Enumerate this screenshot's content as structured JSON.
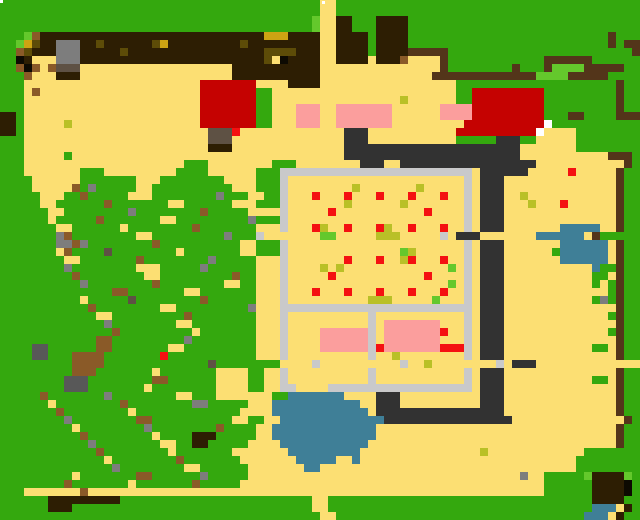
{
  "map": {
    "type": "pixel-art-overworld-farm-map",
    "width_px": 640,
    "height_px": 520,
    "cell_size": 8,
    "cols": 80,
    "rows": 65,
    "palette": {
      "G": "#34a80e",
      "g": "#64c82c",
      "Y": "#fcdf73",
      "D": "#2d1e03",
      "b": "#53351a",
      "A": "#8a5a28",
      "O": "#cda313",
      "o": "#5d4c08",
      "K": "#0d0a02",
      "S": "#7d7d7d",
      "s": "#5e5144",
      "h": "#585858",
      "F": "#c9c9ca",
      "P": "#fb9e9d",
      "R": "#c50201",
      "r": "#f41111",
      "W": "#3f7f97",
      "y": "#b9c027",
      "T": "#323232",
      "w": "#ffffff"
    },
    "palette_legend": {
      "G": "grass",
      "g": "light-grass-bush",
      "Y": "sand-field",
      "D": "tilled-dark-soil",
      "b": "wood-fence-line",
      "A": "dirt-debris",
      "O": "gold-hay",
      "o": "olive-soil-speckle",
      "K": "black",
      "S": "stone-gray",
      "s": "stone-brown",
      "h": "dark-stone",
      "F": "light-gray-fence",
      "P": "pink-building",
      "R": "red-roof-building",
      "r": "red-crop-or-item",
      "W": "water-pond",
      "y": "olive-crop",
      "T": "slate-path",
      "w": "white-door"
    },
    "markers": [
      {
        "name": "white-marker-top-left",
        "x": 0,
        "y": 0,
        "color": "#ffffff"
      },
      {
        "name": "white-marker-top-center",
        "x": 322,
        "y": 1,
        "color": "#ffffff"
      }
    ],
    "grid_rows": [
      "GGGGGGGGGGGGGGGGGGGGGGGGGGGGGGGGGGGGGGGGYYGGGGGGGGGGGGGGGGGGGGGGGGGGGGGGGGGGGG",
      "GGGGGGGGGGGGGGGGGGGGGGGGGGGGGGGGGGGGGGGGYYGGGGGGGGGGGGGGGGGGGGGGGGGGGGGGGGGGGG",
      "GGGGGGGGGGGGGGGGGGGGGGGGGGGGGGGGGGGGGGGgYYDDGGGDDDDGGGGGGGGGGGGGGGGGGGGGGGGGGGG",
      "GGGGGGGGGGGGGGGGGGGGGGGGGGGGGGGGGGGGGGGgYYDDGGGDDDDGGGGGGGGGGGGGGGGGGGGGGGGGGGG",
      "GGGgADDDDDDDDDDDDDDDDDDDDDDDDDDDDOOODDDDYYDDDDGDDDDGGGGGGGGGGGGGGGGGGGGGGGGGbGGG",
      "GGgOoDDSSSDDoDDDDDDoODDDDDDDDDoDDDDDDDDDYYDDDDGDDDDGGGGGGGGGGGGGGGGGGGGGGGGGbGbb",
      "GGAoDDDSSSDDDDDoDDDDDDDDDDDDDDDDDooooDDDYYDDDDGDDDDbbbbbGGGGGGGGGGGGGGGGGGGGGGGb",
      "GGKDYYYSSSDDDDDDDDDDDDDDDDDDDDDDDoYKDDDDYYDDDDYDDDAYYYYbGGGGGGGGGGGGbbbbbbGGGGGG",
      "GGAKAYAsssYYYYYYYYYYYYYYYYYYYDDDDDDDDDDDYYYYYYYYYYYYYYYbGGGGGGGGbGGGbggggbbbbbGG",
      "GGGAYYYDDDYYYYYYYYYYYYYYYYYYYDDDDDDDDDDDYYYYYYYYYYYYYYbbbbbbbbbbbbbggggbbbbbGG",
      "GGGYYYYYYYYYYYYYYYYYYYYYYRRRRRRRYYYYDDDDYYYYYYYYYYYYYYYYYGGGGGGGGGGGGGGGGGGGGbGG",
      "GGGYAYYYYYYYYYYYYYYYYYYYYRRRRRRRGGYYYYYYYYYYYYYYYYYYYYYYYGGRRRRRRRRRGGGGGGGGGbGG",
      "GGGYYYYYYYYYYYYYYYYYYYYYYRRRRRRRGGYYYYYYYYYYYYYYYYyYYYYYYGGRRRRRRRRRGGGGGGGGGbGG",
      "GGGYYYYYYYYYYYYYYYYYYYYYYRRRRRRRGGYYYPPPYYPPPPPPPYYYYYYPPPPRRRRRRRRRGGGGGGGGGbGG",
      "DDGYYYYYYYYYYYYYYYYYYYYYYRRRRRRRGGYYYPPPYYPPPPPPPYYYYYYPPPPRRRRRRRRRGGGbbGGGGbbb",
      "DDGYYYYYyYYYYYYYYYYYYYYYYRRRRRRRGGYYYPPPYYPPPPPPPYYYYYYYYYRRRRRRRRRRwGGGGGGGGGGG",
      "DDGYYYYYYYYYYYYYYYYYYYYYYYsssrYYYYYYYYYYYYYTTTYYYYYYYYYYYRRRRRRRRRRwYYYYGGGGGGG",
      "GGGYYYYYYYYYYYYYYYYYYYYYYYsssYYYYYYYYYYYYYYTTTYYYYYYYYYYYGGGGGTTTGGYYYYYGGGGGGG",
      "GGGYYYYYYYYYYYYYYYYYYYYYYYDDDYYYYYYYYYYYYYYTTTTTTTTTTTTTTTTTTTTTTYYYYYYYGGGGGGG",
      "GGGYYYYYGYYYYYYYYYYYYYYYYYYYYYYYYYYYYYYYYYYTTTTTTTTTTTTTTTTTTTTTTYYYYYYYYYYYbbb",
      "GGGYYYYYYYYYYYYYYYYYYYYGGGYYYYYYYYGGGYYYYYYYYTTTYYTTTTTTTTTTTTTTTTTYYYYYYYYYYYbGG",
      "GGGYYYYYYYGGGYYYYYYYYYGGGGYYYYYYGGGFFFFFFFFFFFFFFFFFFFFFFFFYTTTTTTYYYYYrYYYYYbGG",
      "GGGGYYYYYYGGGGGGGYYYGGGGGGGGYYYYGGGFYYYYYYYYYYYYYYYYYYYYYYFYTTTYYYYYYYYYYYYYYbGG",
      "GGGGYYYYYAGSGGGGGYYGGGGGGGGGGYYYGGGFYYYYYYYYyYYYYYYYyYYYYYFYTTTYYYYYYYYYYYYYYbGG",
      "GGGGGYYYGGAGGGGGYYYGGGGGGGGSGGGYYGGFYYYrYYYrYYYrYYYrYYYrYYFYTTTYYyYYYYYYYYYYYbGG",
      "GGGGGYYGGGGGGAGGGGGGGYYGGGGGGYYYGGGFYYYYYYYyYYYYYYyYYYYYYYFYTTTYYYyYYYrYYYYYYbGG",
      "GGGGGGYYGGGGGGGGSGGGGGGGGAGGGGGYYYYFYYYYYrYYYYYYYYYYYrYYYYFYTTTYYYYYYYYYYYYYYbGG",
      "GGGGGGYGGGGGAGGGGGGGYYGGGGGGGGGSGGGFYYYYYYYYYYYYYYYYYYYYYYFYTTTYYYYYYYYYYYYYYbGG",
      "GGGGGGGYYGGGGGGYGGGGGGGGAGGGGGGGYYYFYYYryYYrYYYryYYrYYYrYYFYTTTYYYYYYYWWWWWYYbGG",
      "GGGGGGGSAGGGGGGGGYYGGGGGGGGGSGGGFYYYYYYYggYYYYYyyyYYYYYFYTTTYYYYYYYWWWWWWYbGG",
      "GGGGGGGSSASGGGGGGGGAGGGGGGGGGGYYGGGFYYYYYYYYYYYYYYYYYYYYYYFYTTTYYYYYYYWWWWWWYbGG",
      "GGGGGGGYAGGGGsGGGGGGGGYGGGGGGGYYGGGFYYYYYYYYYYYYYYgyYYYYYYFYTTTYYYYYYGWWWWWWYbGG",
      "GGGGGGGGYYGGGGGGGAGGGGGGGGSGGGGGYYYFYYYYYYYrYYYrYYyrYYYrYYFYTTTYYYYYYYWWWWWWYbGG",
      "GGGGGGGGSGGGGGGGGYYYGGGGGSGGGGGGYYYFYYYYyYyYYYYYYYYYYYYYgYFYTTTYYYYYYYYYYYWGGbGG",
      "GGGGGGGGGAGGGGGGGGYYGGGGGGGGGAGGYYYFYYYYYrYYYYYYYYYYYrYYYYFYTTTYYYYYYYYYYYGGYbGG",
      "GGGGGGGGGGSGGGGGGGGAGGGGGGGGYYGGYYYFYYYYYYYYYYYYYYYYYYYYgYFYTTTYYYYYYYYYYYGYGbGG",
      "GGGGGGGGGGGGGGAAGGGGGGGYYGGGGGGGYYYFYYYrYYYrYYYrYYYrYYYrYYFYTTTYYYYYYYYYYYYYGbGG",
      "GGGGGGGGGGYGGGGGsGGGGGGGGAGGGGGGYYYFYYYYYYYYYYyyyYYYYYgYYYFYTTTYYYYYYYYYYYGSGbGG",
      "GGGGGGGGGGGAGGGGGGGGYYGGGGGGGGGSYYYFFFFFFFFFFFFFFFFFFFFFFFFYTTTYYYYYYYYYYYYYYbGG",
      "GGGGGGGGGGGGYYGGGGGGGGGAGGGGGGGGYYYFYYYYYYYYYYFYYYYYYYYYYYFYTTTYYYYYYYYYYYYYGbGG",
      "GGGGGGGGGGGGGSGGGGGGGGYYGGGGGGGGYYYFYYYYYYYYYYFYPPPPPPPYYYFYTTTYYYYYYYYYYYYYYbGG",
      "GGGGGGGGGGGGGGAGGGGGGGGGYGGGGGGGYYYFYYYYPPPPPPFYPPPPPPPrYYFYTTTYYYYYYYYYYYYYGbGG",
      "GGGGGGGGGGGGAAGGGGGGGGGSGGGGGGGGYYYFYYYYPPPPPPFYPPPPPPPYYYFYTTTYYYYYYYYYYYYYYbGG",
      "GGGGhhGGGGGGAAGGGGGGGYYGGGGGGGGGYYYFYYYYPPPPPPFrPPPPPPPrrrFYTTTYYYYYYYYYYYGGYbGG",
      "GGGGhhGGGAAAAGGGGGGGrGGGGGGGGGGGYYYFYYYYYYYYYYFYYyYYYYYYYYFYTTTYYYYYYYYYYYYYYbGG",
      "GGGGGGGGGAAAAGGGGGGGGGGGGGsGGGGGGGGYYYYFYYYYYYYYYYFYYyYYYYYYYYFYTTTYYYYYYYYYYYYYYbGG",
      "GGGGGGGGGAAAGGGGGGGYGGGGGGGYYYYGGYYFYYYYYYYYYYFYYYYYYYYYYYFYTTTYYYYYYYYYYYYYYbGG",
      "GGGGGGGGhhhGGGGGGGGAAGGGGGGYYYYGGYYFYYYYYYYYYYFYYYYYYYYYYYFYTTTYYYYYYYYYYYGGYbGG",
      "GGGGGGGGhhhGGGGGGGYGGGGGGGGYYYYGGYYFFYYYYFFFFFFFFFFFFFFFFFFYTTTYYYYYYYYYYYYYYbGG",
      "GGGGGAGGGGGGGSGGGGGGGGYYGGGYYYYYYYGGWWWWWWWYYYYTTTYYYYYYYYYYTTTYYYYYYYYYYYYYYbGG",
      "GGGGGGYGGGGGGGGAGGGGGGGGSSGGGGGYYYWWWWWWWWWWWYYTTTYYYYYYYYYYTTTYYYYYYYYYYYYYYbGG",
      "GGGGGGGAGGGGGGGGYGGGGGGGGGGGGGYYYYWWWWWWWWWWWWYTTTTTTTTTTTTTTTTYYYYYYYYYYYYYYbGG",
      "GGGGGGGGSGGGGGGGGAAGGGGGGGGGGYYGGYYWWWWWWWWWWWWWTTTTTTTTTTTTTTTTYYYYYYYYYYYYYYbGG",
      "GGGGGGGGGYGGGGGGGGSGGGGGGGGAGGGGYYWWWWWWWWWWWWWYYYYYYYYYYYYYYYYYYYYYYYYYYYYYYbGG",
      "GGGGGGGGGGAGGGGGGGGYGGGGDDDGGGGGYYWWWWWWWWWWWWWYYYYYYYYYYYYYYYYYYYYYYYYYYYYYYbGG",
      "GGGGGGGGGGGSGGGGGGGGYYGGDDGGGGGYYYYWWWWWWWWWWWYYYYYYYYYYYYYYYYYYYYYYYYYYYYYYYbGG",
      "GGGGGGGGGGGGAGGGGGGGGYGGGGGGGYYYYYYYWWWWWWWWWYYYYYYYYYYYYYYYyYYYYYYYYYYYYGGGGGGG",
      "GGGGGGGGGGGGGYGGGGGGGGAGGGGGGGYYYYYYYWWWWWYYWYYYYYYYYYYYYYYYYYYYYYYYYYYYGGGGGGG",
      "GGGGGGGGGGGGGGSGGGGGGGGYYGGGGGGYYYYYYYWWYYYYYYYYYYYYYYYYYYYYYYYYYYYYYYYYGGGGGGG",
      "GGGGGGGGGYGGGGGGGAAGGGGGGSGGGGGYYYYYYYYYYYYYYYYYYYYYYYYYYYYYYYYYYSYYGGGGGgDDDDg",
      "GGGGGGGGAGGGGGGGYGGGGGGGAGGGGGYYYYYYYYYYYYYYYYYYYYYYYYYYYYYYYYYYYYYYGGGGGGDDDDK",
      "GGGYYYYYYYAYYYYYYYYYYYYYYYYYYYYYYYYYYYYYYYYYYYYYYYYYYYYYYYYYYYYYYYYYGGGGGGDDDDK",
      "GGGGGGDDDDDDDDDGGGGGGGGGGGGGGGGGGGGGGGGYYGGGGGGGGGGGGGGGGGGGGGGGGGGGGGGGGGDDDDG",
      "GGGGGGDDDGGGGGGGGGGGGGGGGGGGGGGGGGGGGGGYYGGGGGGGGGGGGGGGGGGGGGGGGGGGGGGGGGWWWYD",
      "GGGGGGGGGGGGGGGGGGGGGGGGGGGGGGGGGGGGGGGGYYGGGGGGGGGGGGGGGGGGGGGGGGGGGGGGGWWWYD"
    ]
  }
}
